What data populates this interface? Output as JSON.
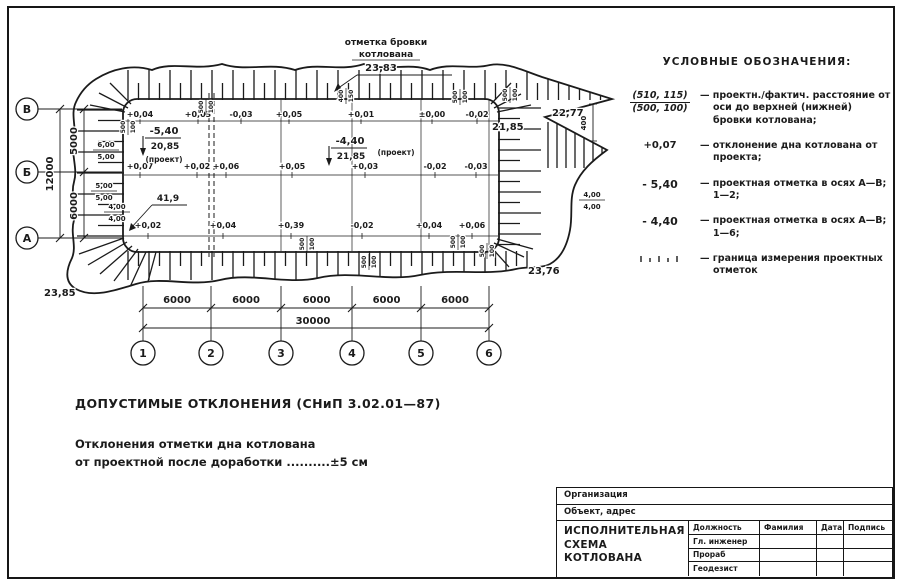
{
  "legend": {
    "title": "УСЛОВНЫЕ ОБОЗНАЧЕНИЯ:",
    "items": [
      {
        "symbol_top": "(510, 115)",
        "symbol_bottom": "(500, 100)",
        "text": "— проектн./фактич. расстояние от оси до верхней (нижней) бровки котлована;"
      },
      {
        "symbol": "+0,07",
        "text": "— отклонение дна котлована от проекта;"
      },
      {
        "symbol": "- 5,40",
        "text": "— проектная отметка в осях А—В; 1—2;"
      },
      {
        "symbol": "- 4,40",
        "text": "— проектная отметка в осях А—В; 1—6;"
      },
      {
        "symbol": "hatch",
        "text": "— граница измерения проектных отметок"
      }
    ]
  },
  "notes": {
    "title": "ДОПУСТИМЫЕ ОТКЛОНЕНИЯ (СНиП 3.02.01—87)",
    "line1": "Отклонения отметки дна котлована",
    "line2": "от проектной после доработки ..........±5 см"
  },
  "title_block": {
    "organization_label": "Организация",
    "object_label": "Объект, адрес",
    "doc_title": "ИСПОЛНИТЕЛЬНАЯ\nСХЕМА\nКОТЛОВАНА",
    "columns": [
      "Должность",
      "Фамилия",
      "Дата",
      "Подпись"
    ],
    "roles": [
      "Гл. инженер",
      "Прораб",
      "Геодезист"
    ]
  },
  "drawing": {
    "brow_label_line1": "отметка бровки",
    "brow_label_line2": "котлована",
    "brow_value": "23,83",
    "elevations": [
      {
        "v": "23,85",
        "x": 44,
        "y": 296
      },
      {
        "v": "23,76",
        "x": 528,
        "y": 274
      },
      {
        "v": "22,77",
        "x": 552,
        "y": 116
      },
      {
        "v": "21,85",
        "x": 492,
        "y": 130
      }
    ],
    "right_gap_dim": "400",
    "axes_bottom": {
      "labels": [
        "1",
        "2",
        "3",
        "4",
        "5",
        "6"
      ],
      "x": [
        143,
        211,
        281,
        352,
        421,
        489
      ]
    },
    "axes_left": {
      "labels": [
        "В",
        "Б",
        "А"
      ],
      "y": [
        109,
        172,
        238
      ]
    },
    "dims_bottom": {
      "bays": [
        "6000",
        "6000",
        "6000",
        "6000",
        "6000"
      ],
      "total": "30000"
    },
    "dims_left": {
      "total": "12000",
      "spans": [
        "5000",
        "6000"
      ]
    },
    "rows": [
      {
        "y": 117,
        "line_y": 121,
        "values": [
          {
            "x": 140,
            "v": "+0,04"
          },
          {
            "x": 198,
            "v": "+0,03"
          },
          {
            "x": 241,
            "v": "-0,03"
          },
          {
            "x": 289,
            "v": "+0,05"
          },
          {
            "x": 361,
            "v": "+0,01"
          },
          {
            "x": 432,
            "v": "±0,00"
          },
          {
            "x": 477,
            "v": "-0,02"
          }
        ]
      },
      {
        "y": 169,
        "line_y": 175,
        "values": [
          {
            "x": 140,
            "v": "+0,07"
          },
          {
            "x": 197,
            "v": "+0,02"
          },
          {
            "x": 226,
            "v": "+0,06"
          },
          {
            "x": 292,
            "v": "+0,05"
          },
          {
            "x": 365,
            "v": "+0,03"
          },
          {
            "x": 435,
            "v": "-0,02"
          },
          {
            "x": 476,
            "v": "-0,03"
          }
        ]
      },
      {
        "y": 228,
        "line_y": 236,
        "values": [
          {
            "x": 148,
            "v": "+0,02"
          },
          {
            "x": 223,
            "v": "+0,04"
          },
          {
            "x": 291,
            "v": "+0,39"
          },
          {
            "x": 362,
            "v": "-0,02"
          },
          {
            "x": 429,
            "v": "+0,04"
          },
          {
            "x": 472,
            "v": "+0,06"
          }
        ]
      }
    ],
    "project_marks": [
      {
        "cx": 164,
        "y": 134,
        "top": "-5,40",
        "bottom": "20,85",
        "note": "(проект)",
        "nx": 164,
        "ny": 162,
        "ax": 143
      },
      {
        "cx": 350,
        "y": 144,
        "top": "-4,40",
        "bottom": "21,85",
        "note": "(проект)",
        "nx": 396,
        "ny": 155,
        "ax": 329
      }
    ],
    "slope_leader": {
      "v": "41,9"
    },
    "edge_pairs_h": [
      {
        "x": 106,
        "y": 147,
        "top": "6,00",
        "bottom": "5,00"
      },
      {
        "x": 104,
        "y": 188,
        "top": "5,00",
        "bottom": "5,00"
      },
      {
        "x": 117,
        "y": 209,
        "top": "4,00",
        "bottom": "4,00"
      },
      {
        "x": 592,
        "y": 197,
        "top": "4,00",
        "bottom": "4,00"
      }
    ],
    "edge_pairs_v": [
      {
        "x": 205,
        "y": 107,
        "top": "500",
        "bottom": "100"
      },
      {
        "x": 345,
        "y": 96,
        "top": "400",
        "bottom": "150"
      },
      {
        "x": 459,
        "y": 97,
        "top": "500",
        "bottom": "100"
      },
      {
        "x": 509,
        "y": 95,
        "top": "500",
        "bottom": "100"
      },
      {
        "x": 127,
        "y": 127,
        "top": "500",
        "bottom": "100"
      },
      {
        "x": 306,
        "y": 244,
        "top": "500",
        "bottom": "100"
      },
      {
        "x": 368,
        "y": 262,
        "top": "500",
        "bottom": "100"
      },
      {
        "x": 457,
        "y": 242,
        "top": "500",
        "bottom": "100"
      },
      {
        "x": 486,
        "y": 251,
        "top": "500",
        "bottom": "100"
      }
    ]
  }
}
